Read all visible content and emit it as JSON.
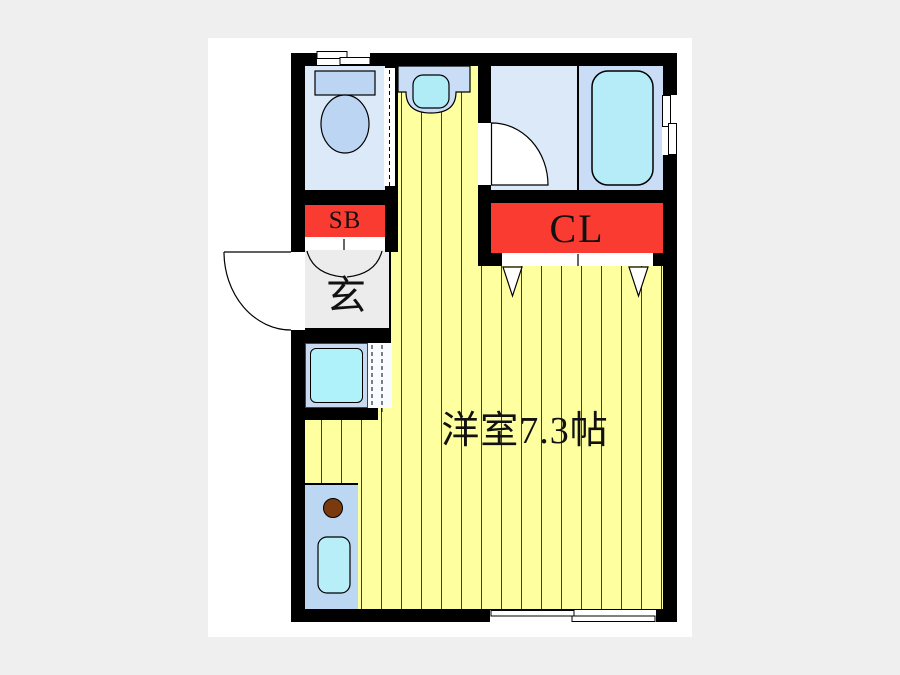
{
  "document": {
    "type": "floor-plan",
    "background": "#efefef",
    "canvas_background": "#ffffff"
  },
  "labels": {
    "shoe_box": "SB",
    "closet": "CL",
    "entrance": "玄",
    "main_room": "洋室7.3帖"
  },
  "rooms": [
    {
      "name": "toilet-room"
    },
    {
      "name": "washbasin-corridor"
    },
    {
      "name": "bathroom"
    },
    {
      "name": "entrance-genkan",
      "label": "玄"
    },
    {
      "name": "shoe-box",
      "label": "SB"
    },
    {
      "name": "closet",
      "label": "CL"
    },
    {
      "name": "kitchen"
    },
    {
      "name": "washing-machine-space"
    },
    {
      "name": "western-room",
      "label": "洋室7.3帖",
      "size_tatami": 7.3
    }
  ],
  "fixtures": [
    "toilet",
    "washbasin",
    "bathtub",
    "washing-machine",
    "stove-burner",
    "kitchen-sink",
    "window",
    "door"
  ],
  "colors": {
    "wall": "#000000",
    "floor_yellow": "#feff9e",
    "accent_red": "#f93b31",
    "room_blue_light": "#dce9f8",
    "bathroom_blue": "#c9def6",
    "fixture_blue": "#bcd5f2",
    "water_cyan": "#b5ecf8",
    "genkan_gray": "#ececec",
    "burner_brown": "#7a3a10"
  }
}
